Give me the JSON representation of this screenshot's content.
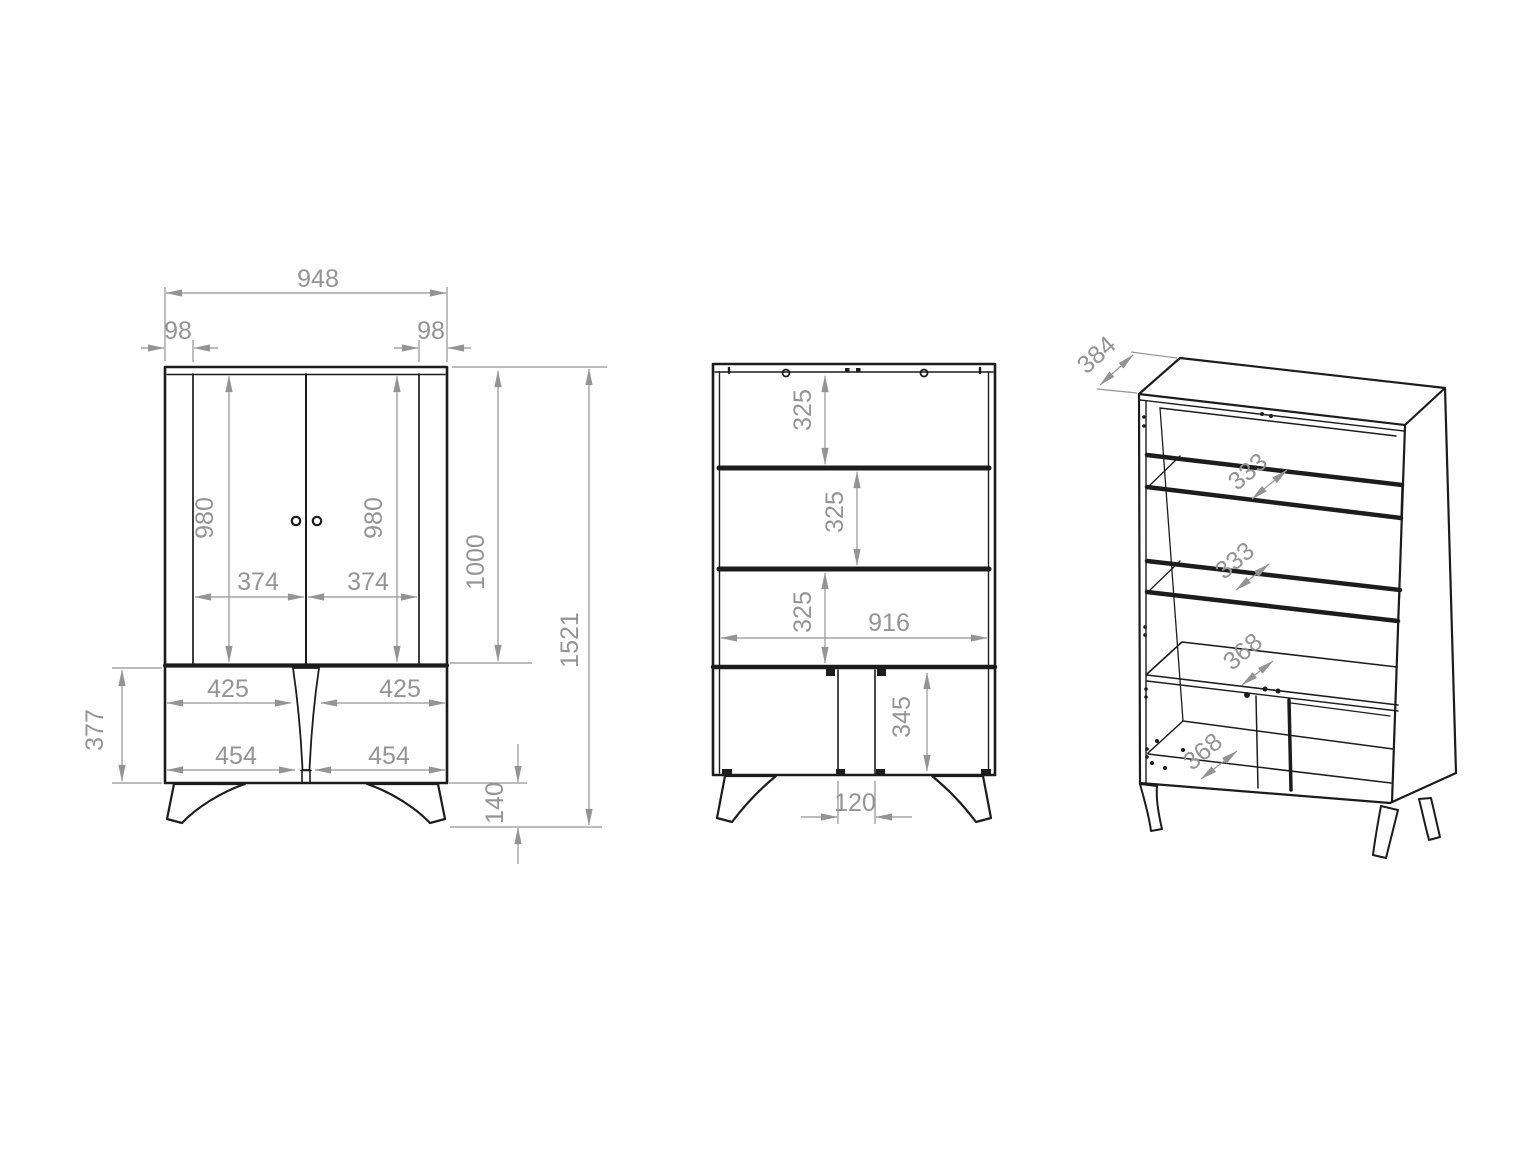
{
  "title": "cabinet-technical-drawing",
  "colors": {
    "background": "#ffffff",
    "line": "#1c1c1c",
    "dimension": "#949494"
  },
  "views": {
    "front": {
      "name": "front-view",
      "dims": {
        "overall_width": "948",
        "left_panel_width": "98",
        "right_panel_width": "98",
        "left_door_height": "980",
        "right_door_height": "980",
        "left_door_width": "374",
        "right_door_width": "374",
        "upper_section_height": "1000",
        "overall_height": "1521",
        "lower_left_width": "425",
        "lower_right_width": "425",
        "lower_left_door_width": "454",
        "lower_right_door_width": "454",
        "lower_section_height": "377",
        "leg_height": "140"
      }
    },
    "internal": {
      "name": "internal-front-view",
      "dims": {
        "shelf_gap_1": "325",
        "shelf_gap_2": "325",
        "shelf_gap_3": "325",
        "internal_width": "916",
        "bottom_compartment_height": "345",
        "center_divider_width": "120"
      }
    },
    "isometric": {
      "name": "isometric-view",
      "dims": {
        "overall_depth": "384",
        "glass_shelf_depth_1": "333",
        "glass_shelf_depth_2": "333",
        "fixed_shelf_depth": "368",
        "bottom_panel_depth": "368"
      }
    }
  }
}
